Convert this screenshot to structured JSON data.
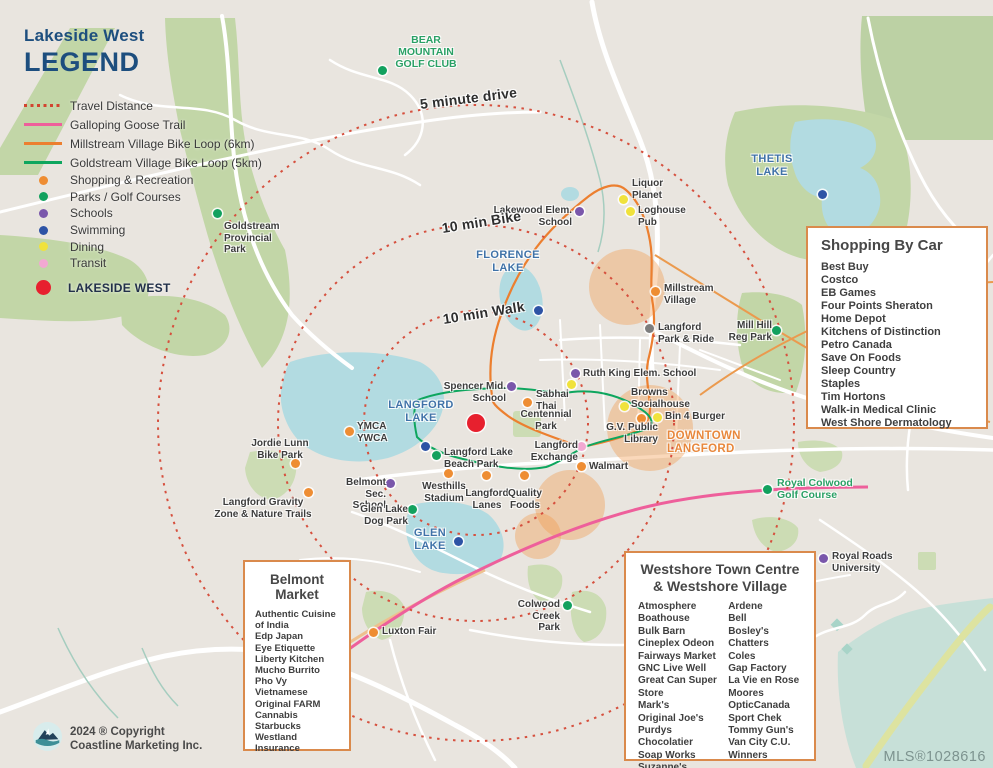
{
  "marker_colors": {
    "shopping": "#ee8d33",
    "parks": "#12a15e",
    "schools": "#7a57ab",
    "swimming": "#2d53a5",
    "dining": "#f0e23c",
    "transit": "#f2a8d2",
    "lakeside": "#e7202e",
    "other": "#7d7d7d"
  },
  "legend": {
    "title": "Lakeside West",
    "heading": "LEGEND",
    "lines": [
      {
        "label": "Travel Distance",
        "color": "#d2442f",
        "style": "dotted"
      },
      {
        "label": "Galloping Goose Trail",
        "color": "#ee5f9b",
        "style": "solid"
      },
      {
        "label": "Millstream Village Bike Loop (6km)",
        "color": "#ec7f2f",
        "style": "solid"
      },
      {
        "label": "Goldstream Village Bike Loop (5km)",
        "color": "#0ea65e",
        "style": "solid"
      }
    ],
    "dots": [
      {
        "label": "Shopping & Recreation",
        "type": "shopping"
      },
      {
        "label": "Parks / Golf Courses",
        "type": "parks"
      },
      {
        "label": "Schools",
        "type": "schools"
      },
      {
        "label": "Swimming",
        "type": "swimming"
      },
      {
        "label": "Dining",
        "type": "dining"
      },
      {
        "label": "Transit",
        "type": "transit"
      }
    ],
    "lakeside_label": "LAKESIDE WEST"
  },
  "boxes": {
    "shopping_by_car": {
      "title": "Shopping By Car",
      "items": [
        "Best Buy",
        "Costco",
        "EB Games",
        "Four Points Sheraton",
        "Home Depot",
        "Kitchens of Distinction",
        "Petro Canada",
        "Save On Foods",
        "Sleep Country",
        "Staples",
        "Tim Hortons",
        "Walk-in Medical Clinic",
        "West Shore Dermatology"
      ]
    },
    "belmont_market": {
      "title": "Belmont Market",
      "items": [
        "Authentic Cuisine",
        "of India",
        "Edp Japan",
        "Eye Etiquette",
        "Liberty Kitchen",
        "Mucho Burrito",
        "Pho Vy",
        "Vietnamese",
        "Original FARM",
        "Cannabis",
        "Starbucks",
        "Westland Insurance"
      ]
    },
    "westshore": {
      "title": "Westshore Town Centre & Westshore Village",
      "col1": [
        "Atmosphere",
        "Boathouse",
        "Bulk Barn",
        "Cineplex Odeon",
        "Fairways Market",
        "GNC Live Well",
        "Great Can Super Store",
        "Mark's",
        "Original Joe's",
        "Purdys Chocolatier",
        "Soap Works",
        "Suzanne's",
        "Urban Art"
      ],
      "col2": [
        "Ardene",
        "Bell",
        "Bosley's",
        "Chatters",
        "Coles",
        "Gap Factory",
        "La Vie en Rose",
        "Moores",
        "OpticCanada",
        "Sport Chek",
        "Tommy Gun's",
        "Van City C.U.",
        "Winners"
      ]
    }
  },
  "map": {
    "pois": [
      {
        "name": "bear-mountain-golf-club",
        "kind": "green",
        "dot": {
          "x": 382,
          "y": 70,
          "type": "parks"
        },
        "label": "BEAR\nMOUNTAIN\nGOLF CLUB",
        "box": {
          "x": 393,
          "y": 34,
          "w": 66,
          "align": "center"
        }
      },
      {
        "name": "goldstream-provincial-park",
        "dot": {
          "x": 217,
          "y": 213,
          "type": "parks"
        },
        "label": "Goldstream\nProvincial\nPark",
        "box": {
          "x": 224,
          "y": 221,
          "w": 70,
          "align": "left"
        }
      },
      {
        "name": "lakewood-elem-school",
        "dot": {
          "x": 579,
          "y": 211,
          "type": "schools"
        },
        "label": "Lakewood Elem. School",
        "box": {
          "x": 466,
          "y": 205,
          "w": 106,
          "align": "right"
        }
      },
      {
        "name": "liquor-planet",
        "dot": {
          "x": 623,
          "y": 199,
          "type": "dining"
        },
        "label": "Liquor\nPlanet",
        "box": {
          "x": 632,
          "y": 178,
          "w": 45,
          "align": "left"
        }
      },
      {
        "name": "loghouse-pub",
        "dot": {
          "x": 630,
          "y": 211,
          "type": "dining"
        },
        "label": "Loghouse\nPub",
        "box": {
          "x": 638,
          "y": 205,
          "w": 52,
          "align": "left"
        }
      },
      {
        "name": "millstream-village",
        "dot": {
          "x": 655,
          "y": 291,
          "type": "shopping"
        },
        "label": "Millstream\nVillage",
        "box": {
          "x": 664,
          "y": 283,
          "w": 62,
          "align": "left"
        }
      },
      {
        "name": "langford-park-and-ride",
        "dot": {
          "x": 649,
          "y": 328,
          "type": "other"
        },
        "label": "Langford\nPark & Ride",
        "box": {
          "x": 658,
          "y": 322,
          "w": 64,
          "align": "left"
        }
      },
      {
        "name": "mill-hill-reg-park",
        "dot": {
          "x": 776,
          "y": 330,
          "type": "parks"
        },
        "label": "Mill Hill\nReg Park",
        "box": {
          "x": 728,
          "y": 320,
          "w": 44,
          "align": "right"
        }
      },
      {
        "name": "thetis-lake",
        "kind": "lake",
        "dot": {
          "x": 822,
          "y": 194,
          "type": "swimming"
        },
        "label": "THETIS\nLAKE",
        "box": {
          "x": 742,
          "y": 153,
          "w": 60,
          "align": "center"
        }
      },
      {
        "name": "florence-lake",
        "kind": "lake",
        "label": "FLORENCE\nLAKE",
        "box": {
          "x": 468,
          "y": 249,
          "w": 80,
          "align": "center"
        }
      },
      {
        "name": "florence-swimming",
        "dot": {
          "x": 538,
          "y": 310,
          "type": "swimming"
        }
      },
      {
        "name": "five-minute-drive",
        "kind": "drive",
        "label": "5 minute drive",
        "box": {
          "x": 420,
          "y": 96,
          "w": 110,
          "align": "left"
        },
        "rot": -7
      },
      {
        "name": "ten-min-bike",
        "kind": "drive",
        "label": "10 min Bike",
        "box": {
          "x": 442,
          "y": 220,
          "w": 95,
          "align": "left"
        },
        "rot": -9
      },
      {
        "name": "ten-min-walk",
        "kind": "drive",
        "label": "10 min Walk",
        "box": {
          "x": 443,
          "y": 311,
          "w": 95,
          "align": "left"
        },
        "rot": -9
      },
      {
        "name": "ruth-king-elem-school",
        "dot": {
          "x": 575,
          "y": 373,
          "type": "schools"
        },
        "label": "Ruth King Elem. School",
        "box": {
          "x": 583,
          "y": 368,
          "w": 120,
          "align": "left"
        }
      },
      {
        "name": "spencer-mid-school",
        "dot": {
          "x": 511,
          "y": 386,
          "type": "schools"
        },
        "label": "Spencer Mid. School",
        "box": {
          "x": 413,
          "y": 381,
          "w": 93,
          "align": "right"
        }
      },
      {
        "name": "sabhai-thai",
        "dot": {
          "x": 571,
          "y": 384,
          "type": "dining"
        },
        "label": "Sabhai Thai",
        "box": {
          "x": 536,
          "y": 389,
          "w": 55,
          "align": "left"
        }
      },
      {
        "name": "centennial-park",
        "dot": {
          "x": 527,
          "y": 402,
          "type": "shopping"
        },
        "label": "Centennial\nPark",
        "box": {
          "x": 520,
          "y": 409,
          "w": 52,
          "align": "center"
        }
      },
      {
        "name": "browns-socialhouse",
        "dot": {
          "x": 624,
          "y": 406,
          "type": "dining"
        },
        "label": "Browns\nSocialhouse",
        "box": {
          "x": 631,
          "y": 387,
          "w": 62,
          "align": "left"
        }
      },
      {
        "name": "bin-4-burger",
        "dot": {
          "x": 657,
          "y": 417,
          "type": "dining"
        },
        "label": "Bin 4 Burger",
        "box": {
          "x": 665,
          "y": 411,
          "w": 68,
          "align": "left"
        }
      },
      {
        "name": "gv-public-library",
        "dot": {
          "x": 641,
          "y": 418,
          "type": "shopping"
        },
        "label": "G.V. Public\nLibrary",
        "box": {
          "x": 600,
          "y": 422,
          "w": 58,
          "align": "right"
        }
      },
      {
        "name": "downtown-langford",
        "kind": "downtown",
        "label": "DOWNTOWN\nLANGFORD",
        "box": {
          "x": 667,
          "y": 430,
          "w": 80,
          "align": "left"
        }
      },
      {
        "name": "langford-exchange",
        "dot": {
          "x": 581,
          "y": 446,
          "type": "transit"
        },
        "label": "Langford\nExchange",
        "box": {
          "x": 528,
          "y": 440,
          "w": 50,
          "align": "right"
        }
      },
      {
        "name": "walmart",
        "dot": {
          "x": 581,
          "y": 466,
          "type": "shopping"
        },
        "label": "Walmart",
        "box": {
          "x": 589,
          "y": 461,
          "w": 50,
          "align": "left"
        }
      },
      {
        "name": "langford-lake",
        "kind": "lake",
        "label": "LANGFORD\nLAKE",
        "box": {
          "x": 385,
          "y": 399,
          "w": 72,
          "align": "center"
        }
      },
      {
        "name": "lakeside-west-marker",
        "dot": {
          "x": 476,
          "y": 423,
          "type": "lakeside",
          "r": 9
        }
      },
      {
        "name": "ymca-ywca",
        "dot": {
          "x": 349,
          "y": 431,
          "type": "shopping"
        },
        "label": "YMCA\nYWCA",
        "box": {
          "x": 357,
          "y": 421,
          "w": 40,
          "align": "left"
        }
      },
      {
        "name": "beach-park-swimming",
        "dot": {
          "x": 425,
          "y": 446,
          "type": "swimming"
        }
      },
      {
        "name": "langford-lake-beach-park",
        "dot": {
          "x": 436,
          "y": 455,
          "type": "parks"
        },
        "label": "Langford Lake\nBeach Park",
        "box": {
          "x": 444,
          "y": 447,
          "w": 70,
          "align": "left"
        }
      },
      {
        "name": "jordie-lunn-bike-park",
        "dot": {
          "x": 295,
          "y": 463,
          "type": "shopping"
        },
        "label": "Jordie Lunn\nBike Park",
        "box": {
          "x": 250,
          "y": 438,
          "w": 60,
          "align": "center"
        }
      },
      {
        "name": "langford-gravity-zone",
        "dot": {
          "x": 308,
          "y": 492,
          "type": "shopping"
        },
        "label": "Langford Gravity\nZone & Nature Trails",
        "box": {
          "x": 212,
          "y": 497,
          "w": 102,
          "align": "center"
        }
      },
      {
        "name": "belmont-sec-school",
        "dot": {
          "x": 390,
          "y": 483,
          "type": "schools"
        },
        "label": "Belmont\nSec. School",
        "box": {
          "x": 330,
          "y": 477,
          "w": 56,
          "align": "right"
        }
      },
      {
        "name": "glen-lake-dog-park",
        "dot": {
          "x": 412,
          "y": 509,
          "type": "parks"
        },
        "label": "Glen Lake\nDog Park",
        "box": {
          "x": 356,
          "y": 504,
          "w": 52,
          "align": "right"
        }
      },
      {
        "name": "westhills-stadium",
        "dot": {
          "x": 448,
          "y": 473,
          "type": "shopping"
        },
        "label": "Westhills\nStadium",
        "box": {
          "x": 420,
          "y": 481,
          "w": 48,
          "align": "center"
        }
      },
      {
        "name": "langford-lanes",
        "dot": {
          "x": 486,
          "y": 475,
          "type": "shopping"
        },
        "label": "Langford\nLanes",
        "box": {
          "x": 464,
          "y": 488,
          "w": 46,
          "align": "center"
        }
      },
      {
        "name": "quality-foods",
        "dot": {
          "x": 524,
          "y": 475,
          "type": "shopping"
        },
        "label": "Quality\nFoods",
        "box": {
          "x": 505,
          "y": 488,
          "w": 40,
          "align": "center"
        }
      },
      {
        "name": "glen-lake",
        "kind": "lake",
        "dot": {
          "x": 458,
          "y": 541,
          "type": "swimming"
        },
        "label": "GLEN\nLAKE",
        "box": {
          "x": 408,
          "y": 527,
          "w": 44,
          "align": "center"
        }
      },
      {
        "name": "colwood-creek-park",
        "dot": {
          "x": 567,
          "y": 605,
          "type": "parks"
        },
        "label": "Colwood\nCreek Park",
        "box": {
          "x": 508,
          "y": 599,
          "w": 52,
          "align": "right"
        }
      },
      {
        "name": "luxton-fair",
        "dot": {
          "x": 373,
          "y": 632,
          "type": "shopping"
        },
        "label": "Luxton Fair",
        "box": {
          "x": 382,
          "y": 626,
          "w": 60,
          "align": "left"
        }
      },
      {
        "name": "royal-colwood-golf-course",
        "kind": "green",
        "dot": {
          "x": 767,
          "y": 489,
          "type": "parks"
        },
        "label": "Royal Colwood\nGolf Course",
        "box": {
          "x": 777,
          "y": 477,
          "w": 82,
          "align": "left"
        }
      },
      {
        "name": "royal-roads-university",
        "dot": {
          "x": 823,
          "y": 558,
          "type": "schools"
        },
        "label": "Royal Roads\nUniversity",
        "box": {
          "x": 832,
          "y": 551,
          "w": 62,
          "align": "left"
        }
      }
    ]
  },
  "footer": {
    "copyright_line1": "2024 ® Copyright",
    "copyright_line2": "Coastline Marketing Inc.",
    "mls": "MLS®1028616"
  }
}
